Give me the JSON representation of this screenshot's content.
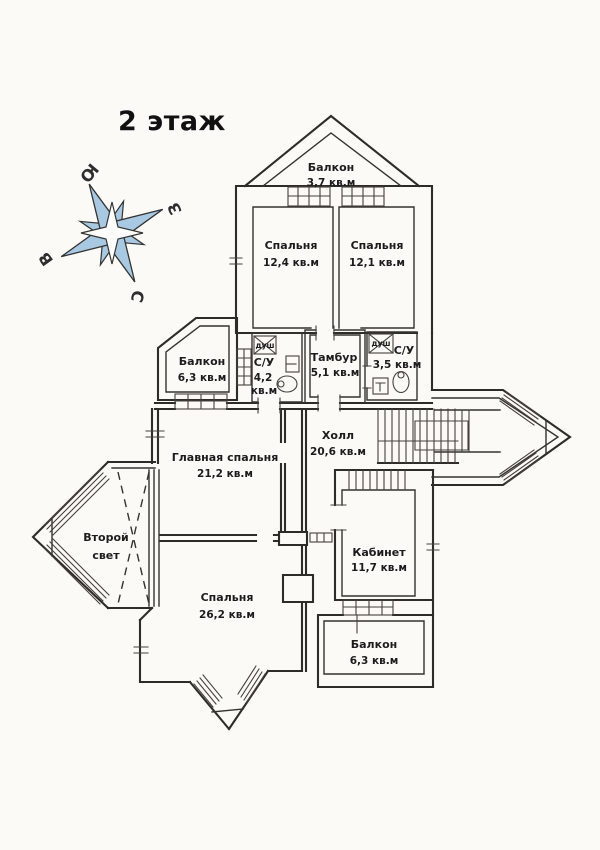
{
  "page": {
    "title": "2 этаж"
  },
  "compass": {
    "letters": {
      "top_left": "Ю",
      "top_right": "З",
      "bottom_left": "В",
      "bottom": "С"
    },
    "star_fill": "#a9c9e2"
  },
  "rooms": [
    {
      "id": "balcony-top",
      "name": "Балкон",
      "area": "3,7 кв.м"
    },
    {
      "id": "bedroom-top-left",
      "name": "Спальня",
      "area": "12,4 кв.м"
    },
    {
      "id": "bedroom-top-right",
      "name": "Спальня",
      "area": "12,1 кв.м"
    },
    {
      "id": "balcony-left",
      "name": "Балкон",
      "area": "6,3 кв.м"
    },
    {
      "id": "bathroom-left",
      "name": "С/У",
      "area_value": "4,2",
      "area_unit": "кв.м",
      "fixture": "душ"
    },
    {
      "id": "vestibule",
      "name": "Тамбур",
      "area": "5,1 кв.м"
    },
    {
      "id": "bathroom-right",
      "name": "С/У",
      "area": "3,5 кв.м",
      "fixture": "душ"
    },
    {
      "id": "hall",
      "name": "Холл",
      "area": "20,6 кв.м"
    },
    {
      "id": "master-bedroom",
      "name": "Главная спальня",
      "area": "21,2 кв.м"
    },
    {
      "id": "second-light",
      "name_line_1": "Второй",
      "name_line_2": "свет"
    },
    {
      "id": "bedroom-bottom",
      "name": "Спальня",
      "area": "26,2 кв.м"
    },
    {
      "id": "office",
      "name": "Кабинет",
      "area": "11,7 кв.м"
    },
    {
      "id": "balcony-bottom",
      "name": "Балкон",
      "area": "6,3 кв.м"
    }
  ]
}
